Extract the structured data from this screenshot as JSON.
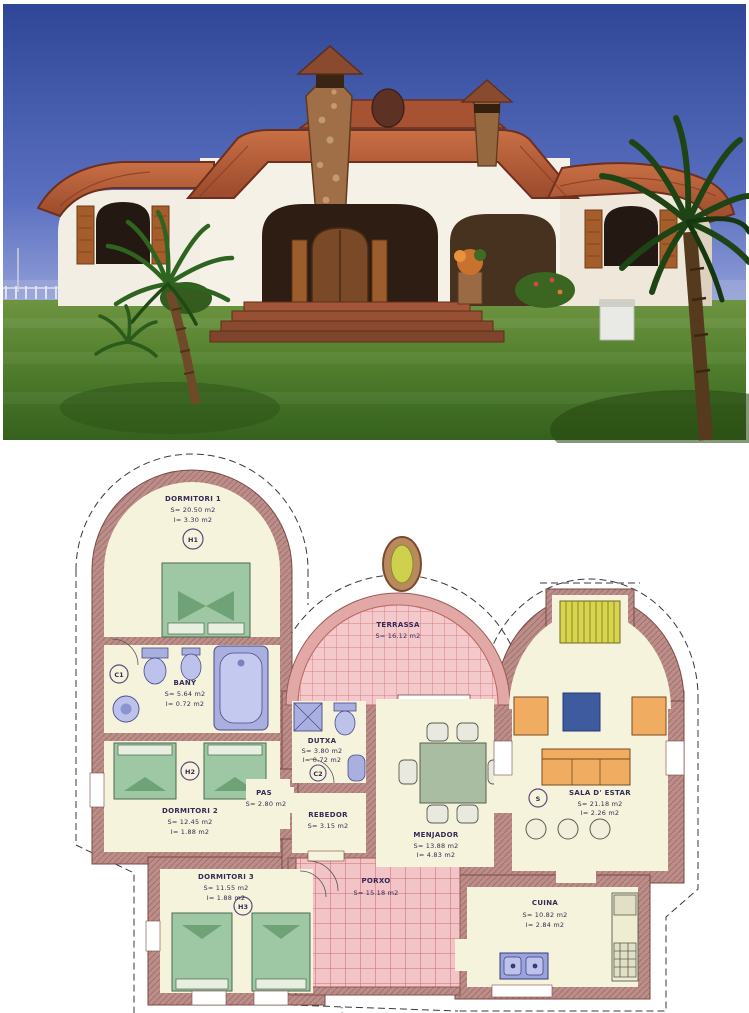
{
  "photo": {
    "subject": "mediterranean-villa-exterior",
    "colors": {
      "sky": "#3d55a6",
      "roof": "#b2583a",
      "wall": "#f3eee3",
      "lawn": "#4f7d2c",
      "stone": "#a06f48"
    }
  },
  "plan": {
    "colors": {
      "wall": "#bc8e8a",
      "floor": "#f6f3dc",
      "tile": "#f4c9cc",
      "tile_line": "#d9807f",
      "bed": "#9ec7a4",
      "fixture": "#a9b0e0",
      "sofa": "#f0ad62",
      "table_blue": "#3d5b9e",
      "dining_table": "#a9bda2",
      "fireplace": "#d8d44e"
    },
    "rooms": [
      {
        "name": "DORMITORI 1",
        "area": "S= 20.50 m2",
        "light": "I= 3.30 m2",
        "tag": "H1"
      },
      {
        "name": "BANY",
        "area": "S= 5.64 m2",
        "light": "I= 0.72 m2",
        "tag": "C1"
      },
      {
        "name": "DORMITORI 2",
        "area": "S= 12.45 m2",
        "light": "I= 1.88 m2",
        "tag": "H2"
      },
      {
        "name": "DORMITORI 3",
        "area": "S= 11.55 m2",
        "light": "I= 1.88 m2",
        "tag": "H3"
      },
      {
        "name": "TERRASSA",
        "area": "S= 16.12 m2"
      },
      {
        "name": "DUTXA",
        "area": "S= 3.80 m2",
        "light": "I= 0.72 m2",
        "tag": "C2"
      },
      {
        "name": "PAS",
        "area": "S= 2.80 m2"
      },
      {
        "name": "REBEDOR",
        "area": "S= 3.15 m2"
      },
      {
        "name": "MENJADOR",
        "area": "S= 13.88 m2",
        "light": "I= 4.83 m2"
      },
      {
        "name": "SALA D' ESTAR",
        "area": "S= 21.18 m2",
        "light": "I= 2.26 m2",
        "tag": "S"
      },
      {
        "name": "CUINA",
        "area": "S= 10.82 m2",
        "light": "I= 2.84 m2"
      },
      {
        "name": "PORXO",
        "area": "S= 15.18 m2"
      }
    ]
  }
}
